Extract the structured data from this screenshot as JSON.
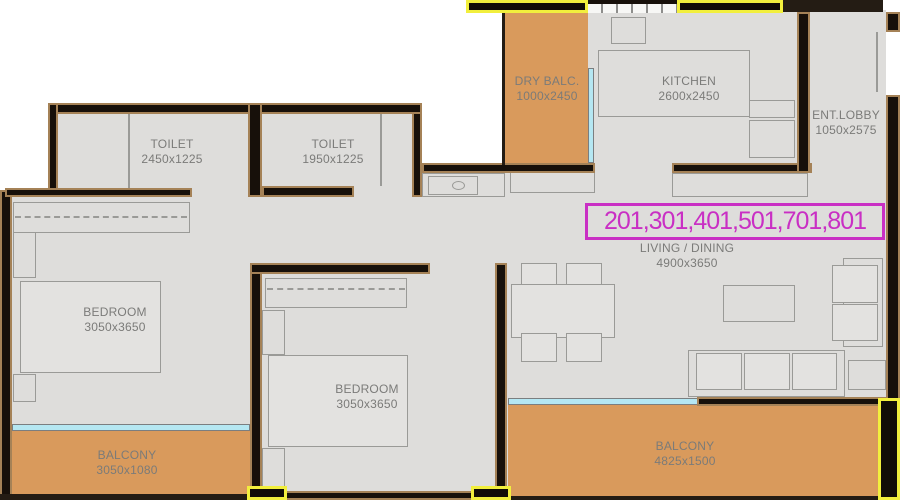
{
  "banner": {
    "text": "201,301,401,501,701,801"
  },
  "rooms": {
    "toilet1": {
      "name": "TOILET",
      "dims": "2450x1225"
    },
    "toilet2": {
      "name": "TOILET",
      "dims": "1950x1225"
    },
    "dry_balcony": {
      "name": "DRY BALC.",
      "dims": "1000x2450"
    },
    "kitchen": {
      "name": "KITCHEN",
      "dims": "2600x2450"
    },
    "entrance_lobby": {
      "name": "ENT.LOBBY",
      "dims": "1050x2575"
    },
    "living_dining": {
      "name": "LIVING / DINING",
      "dims": "4900x3650"
    },
    "bedroom_left": {
      "name": "BEDROOM",
      "dims": "3050x3650"
    },
    "bedroom_middle": {
      "name": "BEDROOM",
      "dims": "3050x3650"
    },
    "balcony_left": {
      "name": "BALCONY",
      "dims": "3050x1080"
    },
    "balcony_right": {
      "name": "BALCONY",
      "dims": "4825x1500"
    }
  },
  "colors": {
    "wall": "#17100a",
    "wall_edge": "#a58257",
    "floor": "#dedddb",
    "balcony_floor": "#d99a5c",
    "window": "#b5e7f2",
    "shear_wall_highlight": "#f2ef3d",
    "unit_highlight": "#c92fc4",
    "label_text": "#7b7b79",
    "furniture_line": "#9a9a97"
  }
}
